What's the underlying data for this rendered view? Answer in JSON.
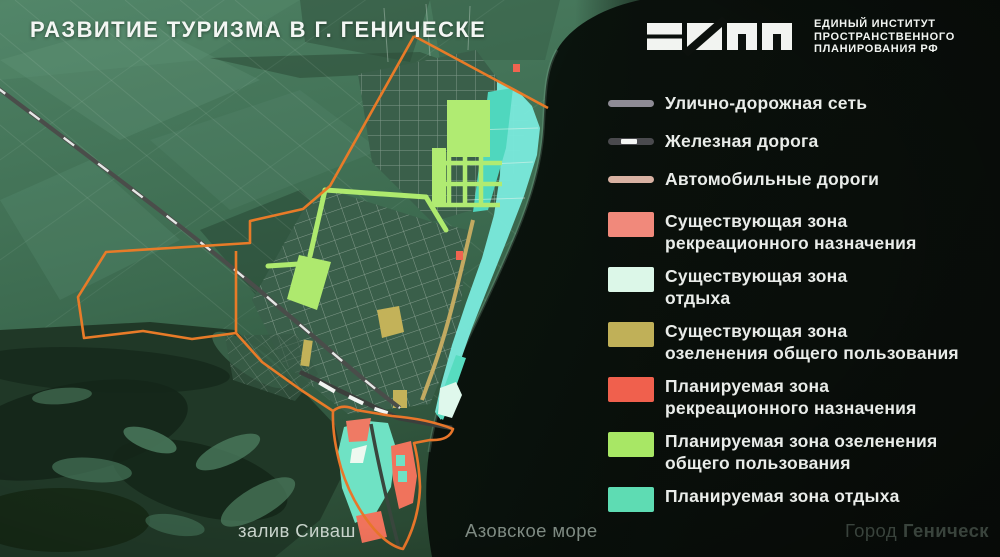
{
  "title": "РАЗВИТИЕ ТУРИЗМА В Г. ГЕНИЧЕСКЕ",
  "logo": {
    "org_line1": "ЕДИНЫЙ ИНСТИТУТ",
    "org_line2": "ПРОСТРАНСТВЕННОГО",
    "org_line3": "ПЛАНИРОВАНИЯ РФ"
  },
  "legend": {
    "lines": [
      {
        "label": "Улично-дорожная сеть",
        "color": "#8e8b95",
        "style": "solid"
      },
      {
        "label": "Железная дорога",
        "color": "#4a4a4e",
        "style": "railway"
      },
      {
        "label": "Автомобильные дороги",
        "color": "#d8b1a2",
        "style": "solid"
      }
    ],
    "zones": [
      {
        "line1": "Существующая зона",
        "line2": "рекреационного назначения",
        "color": "#f1897b"
      },
      {
        "line1": "Существующая зона",
        "line2": "отдыха",
        "color": "#dcf7e8"
      },
      {
        "line1": "Существующая зона",
        "line2": "озеленения общего пользования",
        "color": "#c0b058"
      },
      {
        "line1": "Планируемая зона",
        "line2": "рекреационного назначения",
        "color": "#f0604d"
      },
      {
        "line1": "Планируемая зона озеленения",
        "line2": "общего пользования",
        "color": "#a8e765"
      },
      {
        "line1": "Планируемая зона отдыха",
        "line2": "",
        "color": "#5edcb3"
      }
    ]
  },
  "map_labels": {
    "bay": "залив Сиваш",
    "sea": "Азовское море",
    "city_prefix": "Город",
    "city_name": "Геническ"
  }
}
